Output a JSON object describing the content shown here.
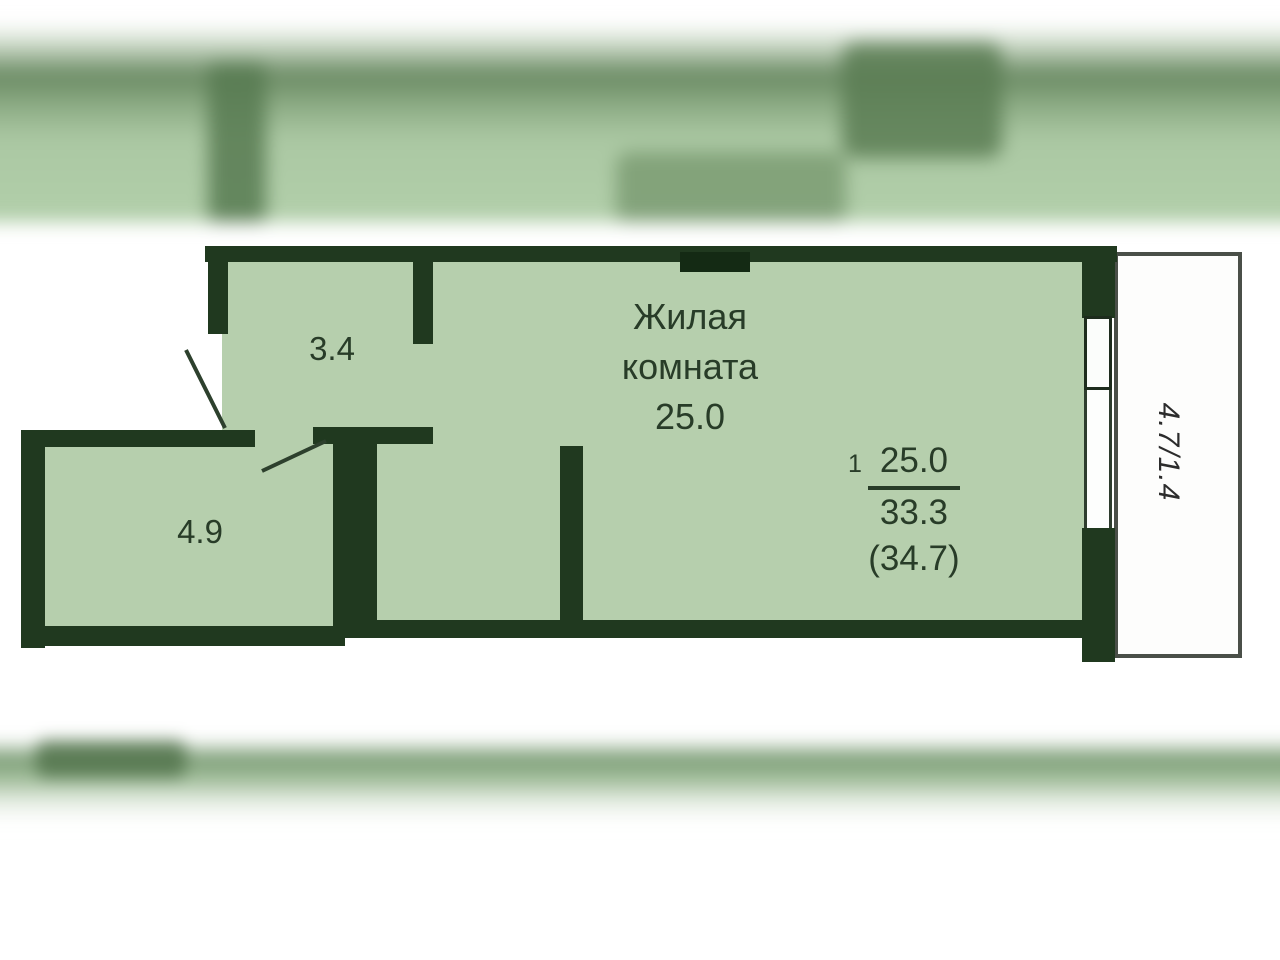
{
  "page": {
    "type": "apartment-floor-plan"
  },
  "plan": {
    "rooms": {
      "living": {
        "label_line1": "Жилая",
        "label_line2": "комната",
        "area": "25.0"
      },
      "hall": {
        "area": "3.4"
      },
      "bathroom": {
        "area": "4.9"
      },
      "balcony": {
        "area": "4.7/1.4"
      }
    },
    "area_summary": {
      "unit_number": "1",
      "living_area": "25.0",
      "total_area": "33.3",
      "total_area_with_balcony": "(34.7)"
    },
    "colors": {
      "floor_fill": "#b6cfad",
      "wall": "#20391f",
      "balcony_outline": "#4a4f48",
      "label_text": "#283c28"
    }
  }
}
